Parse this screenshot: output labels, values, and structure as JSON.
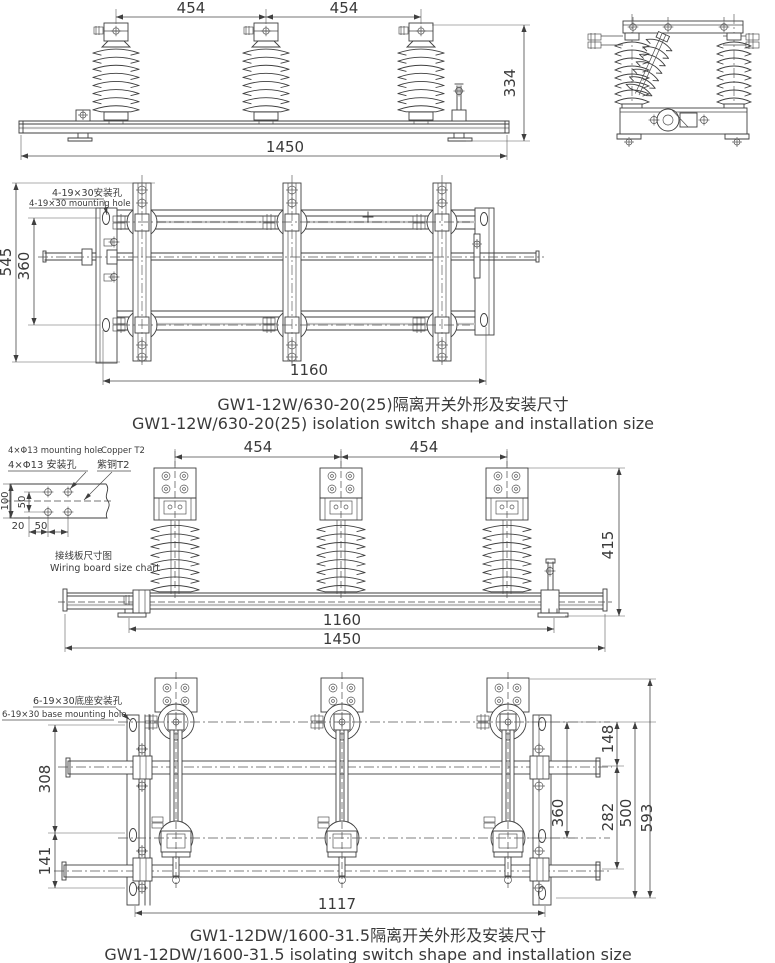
{
  "page": {
    "background": "#ffffff",
    "line_color": "#3f3f3f"
  },
  "top_front_view": {
    "dim_454_left": "454",
    "dim_454_right": "454",
    "dim_334": "334",
    "dim_1450": "1450"
  },
  "plan_view": {
    "dim_545": "545",
    "dim_360": "360",
    "dim_1160": "1160",
    "mounting_hole_zh": "4-19×30安装孔",
    "mounting_hole_en": "4-19×30 mounting hole"
  },
  "caption_gw1_12w": {
    "zh": "GW1-12W/630-20(25)隔离开关外形及安装尺寸",
    "en": "GW1-12W/630-20(25) isolation switch shape and installation size"
  },
  "wiring_board": {
    "hole_en": "4×Φ13 mounting hole",
    "copper_en": "Copper T2",
    "hole_zh": "4×Φ13 安装孔",
    "copper_zh": "紫铜T2",
    "dim_100": "100",
    "dim_50_vertical": "50",
    "dim_20": "20",
    "dim_50_horizontal": "50",
    "caption_zh": "接线板尺寸图",
    "caption_en": "Wiring board size chart"
  },
  "middle_front_view": {
    "dim_454_left": "454",
    "dim_454_right": "454",
    "dim_415": "415",
    "dim_1160": "1160",
    "dim_1450": "1450"
  },
  "bottom_plan_view": {
    "base_hole_zh": "6-19×30底座安装孔",
    "base_hole_en": "6-19×30 base mounting hole",
    "dim_308": "308",
    "dim_141": "141",
    "dim_148": "148",
    "dim_282": "282",
    "dim_360": "360",
    "dim_500": "500",
    "dim_593": "593",
    "dim_1117": "1117"
  },
  "caption_gw1_12dw": {
    "zh": "GW1-12DW/1600-31.5隔离开关外形及安装尺寸",
    "en": "GW1-12DW/1600-31.5 isolating switch shape and installation size"
  }
}
